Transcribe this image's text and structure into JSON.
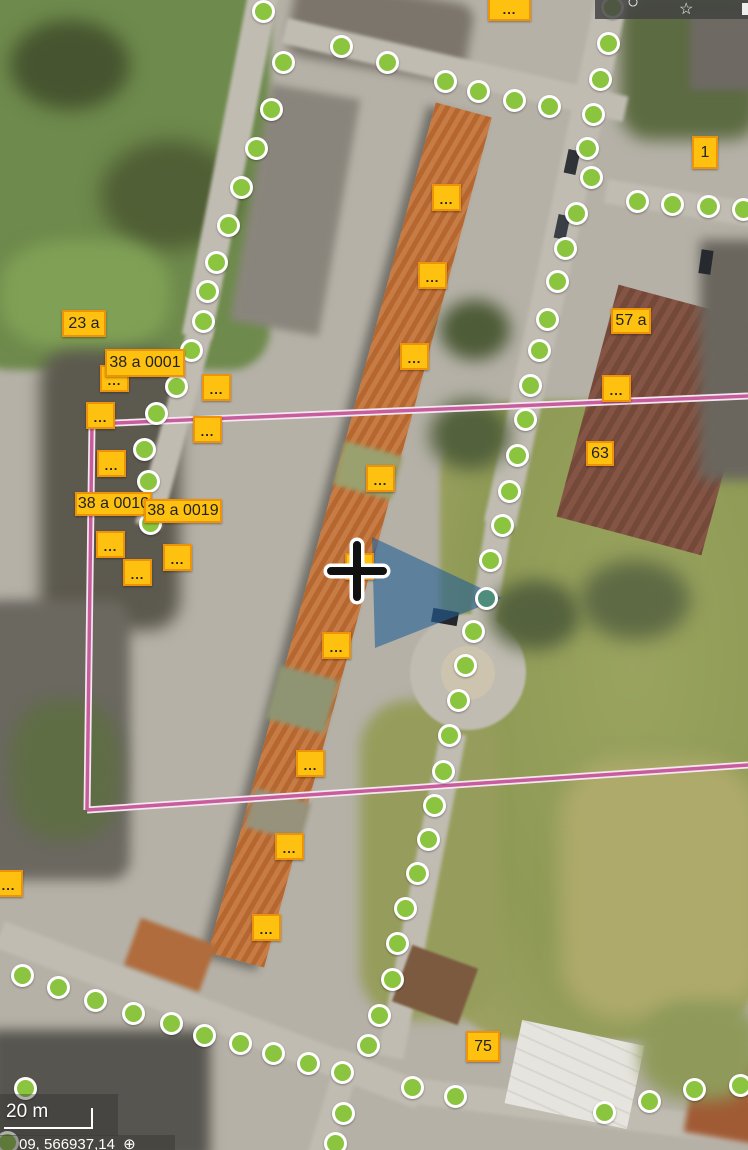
{
  "toolbar": {
    "icons": [
      {
        "name": "circle-icon",
        "glyph": "○"
      },
      {
        "name": "bookmark-star-icon",
        "glyph": "☆"
      }
    ]
  },
  "map": {
    "markers": {
      "green": [
        [
          263,
          11
        ],
        [
          283,
          62
        ],
        [
          271,
          109
        ],
        [
          256,
          148
        ],
        [
          241,
          187
        ],
        [
          228,
          225
        ],
        [
          216,
          262
        ],
        [
          207,
          291
        ],
        [
          203,
          321
        ],
        [
          191,
          350
        ],
        [
          176,
          386
        ],
        [
          156,
          413
        ],
        [
          144,
          449
        ],
        [
          148,
          481
        ],
        [
          150,
          523
        ],
        [
          341,
          46
        ],
        [
          387,
          62
        ],
        [
          445,
          81
        ],
        [
          478,
          91
        ],
        [
          514,
          100
        ],
        [
          549,
          106
        ],
        [
          612,
          7
        ],
        [
          608,
          43
        ],
        [
          600,
          79
        ],
        [
          593,
          114
        ],
        [
          587,
          148
        ],
        [
          591,
          177
        ],
        [
          576,
          213
        ],
        [
          565,
          248
        ],
        [
          557,
          281
        ],
        [
          547,
          319
        ],
        [
          539,
          350
        ],
        [
          530,
          385
        ],
        [
          525,
          419
        ],
        [
          517,
          455
        ],
        [
          509,
          491
        ],
        [
          502,
          525
        ],
        [
          490,
          560
        ],
        [
          473,
          631
        ],
        [
          465,
          665
        ],
        [
          458,
          700
        ],
        [
          449,
          735
        ],
        [
          443,
          771
        ],
        [
          434,
          805
        ],
        [
          428,
          839
        ],
        [
          417,
          873
        ],
        [
          405,
          908
        ],
        [
          397,
          943
        ],
        [
          392,
          979
        ],
        [
          379,
          1015
        ],
        [
          368,
          1045
        ],
        [
          637,
          201
        ],
        [
          672,
          204
        ],
        [
          708,
          206
        ],
        [
          743,
          209
        ],
        [
          22,
          975
        ],
        [
          58,
          987
        ],
        [
          95,
          1000
        ],
        [
          133,
          1013
        ],
        [
          171,
          1023
        ],
        [
          204,
          1035
        ],
        [
          240,
          1043
        ],
        [
          273,
          1053
        ],
        [
          308,
          1063
        ],
        [
          342,
          1072
        ],
        [
          25,
          1088
        ],
        [
          7,
          1142
        ],
        [
          343,
          1113
        ],
        [
          335,
          1143
        ],
        [
          412,
          1087
        ],
        [
          455,
          1096
        ],
        [
          604,
          1112
        ],
        [
          649,
          1101
        ],
        [
          694,
          1089
        ],
        [
          740,
          1085
        ]
      ],
      "teal": [
        [
          486,
          598
        ]
      ]
    },
    "labels": [
      {
        "t": "...",
        "x": 488,
        "y": -7,
        "w": 43,
        "h": 28,
        "dots": true
      },
      {
        "t": "1",
        "x": 692,
        "y": 136,
        "w": 26,
        "h": 33
      },
      {
        "t": "23 a",
        "x": 62,
        "y": 310,
        "w": 44,
        "h": 27
      },
      {
        "t": "38 a 0001",
        "x": 105,
        "y": 349,
        "w": 80,
        "h": 28
      },
      {
        "t": "57 a",
        "x": 611,
        "y": 308,
        "w": 40,
        "h": 26
      },
      {
        "t": "63",
        "x": 586,
        "y": 441,
        "w": 28,
        "h": 25
      },
      {
        "t": "38 a 0010",
        "x": 75,
        "y": 492,
        "w": 77,
        "h": 24
      },
      {
        "t": "38 a 0019",
        "x": 144,
        "y": 499,
        "w": 78,
        "h": 24
      },
      {
        "t": "75",
        "x": 466,
        "y": 1031,
        "w": 34,
        "h": 31
      }
    ],
    "dot_markers": [
      [
        432,
        184
      ],
      [
        418,
        262
      ],
      [
        400,
        343
      ],
      [
        366,
        465
      ],
      [
        345,
        553
      ],
      [
        322,
        632
      ],
      [
        296,
        750
      ],
      [
        275,
        833
      ],
      [
        252,
        914
      ],
      [
        100,
        365
      ],
      [
        202,
        374
      ],
      [
        86,
        402
      ],
      [
        193,
        416
      ],
      [
        97,
        450
      ],
      [
        96,
        531
      ],
      [
        123,
        559
      ],
      [
        163,
        544
      ],
      [
        -6,
        870
      ],
      [
        602,
        375
      ]
    ],
    "boundary": {
      "lines": [
        [
          [
            92,
            424
          ],
          [
            748,
            396
          ]
        ],
        [
          [
            92,
            424
          ],
          [
            87,
            810
          ]
        ],
        [
          [
            87,
            810
          ],
          [
            748,
            765
          ]
        ]
      ]
    },
    "view_cone": {
      "points": "372,537 375,648 502,598"
    },
    "crosshair": {
      "x": 357,
      "y": 571
    }
  },
  "scalebar": {
    "label": "20 m"
  },
  "statusbar": {
    "coords": "09, 566937,14",
    "symbol": "⊕"
  },
  "colors": {
    "label_bg": "#FEC110",
    "label_border": "#EE9209",
    "label_text": "#222222",
    "marker_green": "#8BC53F",
    "marker_ring": "#FFFFFF",
    "marker_teal": "#4E8D7B",
    "boundary_pink": "#C85D9D",
    "boundary_casing": "#F4E7F0",
    "cone_blue": "rgba(35,95,150,0.6)",
    "crosshair_black": "#111111",
    "crosshair_halo": "#FFFFFF"
  }
}
